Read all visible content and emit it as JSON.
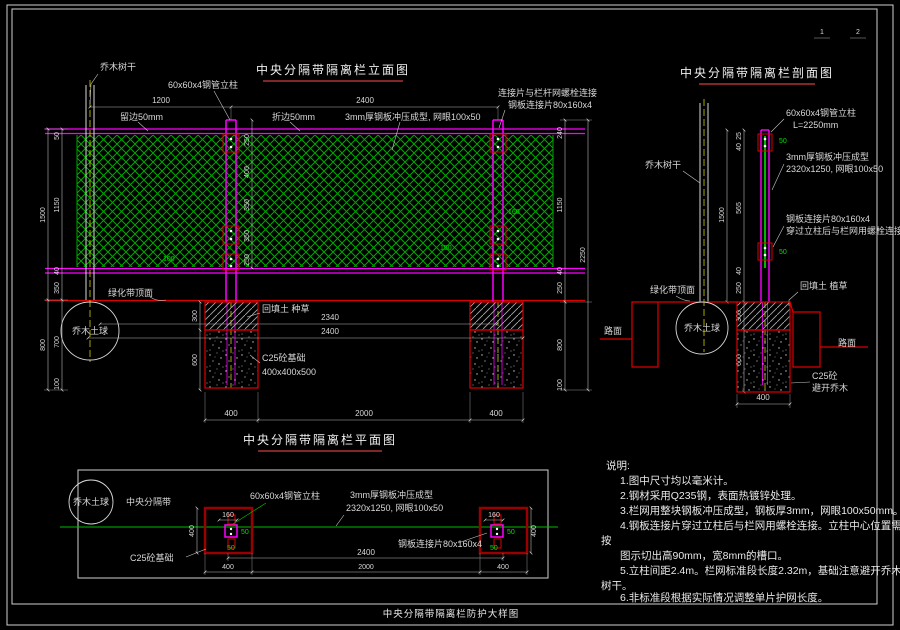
{
  "sheet": {
    "footer_title": "中央分隔带隔离栏防护大样图",
    "page_no_1": "1",
    "page_no_2": "2"
  },
  "elevation": {
    "title": "中央分隔带隔离栏立面图",
    "labels": {
      "tree_trunk": "乔木树干",
      "post": "60x60x4钢管立柱",
      "edge_left": "留边50mm",
      "edge_right": "折边50mm",
      "mesh": "3mm厚钢板冲压成型, 网眼100x50",
      "connect_line1": "连接片与栏杆网螺栓连接",
      "connect_line2": "钢板连接片80x160x4",
      "greenbelt_top": "绿化带顶面",
      "backfill": "回填土 种草",
      "foundation_line1": "C25砼基础",
      "foundation_line2": "400x400x500",
      "tree_ball": "乔木土球"
    },
    "dims": {
      "tree_to_post": "1200",
      "post_spacing": "2400",
      "left_total": "1500",
      "left_top": "50",
      "left_mesh": "1150",
      "left_rail": "40",
      "left_bottom": "350",
      "left_below_total": "800",
      "left_below_1": "700",
      "left_below_2": "100",
      "mid_1": "250",
      "mid_2": "400",
      "mid_3": "350",
      "mid_4": "350",
      "mid_5": "250",
      "right_top": "240",
      "right_mesh": "1150",
      "right_rail": "40",
      "right_bottom": "250",
      "right_total": "2250",
      "right_below_1": "800",
      "right_below_2": "100",
      "hatch_depth": "300",
      "found_depth": "600",
      "panel_len": "2340",
      "bay_len": "2400",
      "found_left": "400",
      "found_gap": "2000",
      "found_right": "400",
      "bolt_1": "100",
      "bolt_2": "150",
      "bolt_3": "160"
    }
  },
  "section": {
    "title": "中央分隔带隔离栏剖面图",
    "labels": {
      "tree_trunk": "乔木树干",
      "post_line1": "60x60x4钢管立柱",
      "post_line2": "L=2250mm",
      "mesh_line1": "3mm厚钢板冲压成型",
      "mesh_line2": "2320x1250, 网眼100x50",
      "plate_line1": "钢板连接片80x160x4",
      "plate_line2": "穿过立柱后与栏网用螺栓连接",
      "backfill": "回填土 植草",
      "greenbelt_top": "绿化带顶面",
      "tree_ball": "乔木土球",
      "road_left": "路面",
      "road_right": "路面",
      "c25_line1": "C25砼",
      "c25_line2": "避开乔木"
    },
    "dims": {
      "top_1": "25",
      "top_2": "40",
      "mesh_upper": "565",
      "rail": "40",
      "to_ground": "250",
      "above_total": "1500",
      "hatch_depth": "300",
      "found_depth": "600",
      "found_width": "400",
      "bolt_top": "50",
      "bolt_mid": "50"
    }
  },
  "plan": {
    "title": "中央分隔带隔离栏平面图",
    "labels": {
      "tree_ball": "乔木土球",
      "median": "中央分隔带",
      "post": "60x60x4钢管立柱",
      "mesh_line1": "3mm厚钢板冲压成型",
      "mesh_line2": "2320x1250, 网眼100x50",
      "plate": "钢板连接片80x160x4",
      "foundation": "C25砼基础"
    },
    "dims": {
      "post_left": "160",
      "post_right": "160",
      "found_left_side": "400",
      "found_right_side": "400",
      "post_spacing": "2400",
      "found_left": "400",
      "found_gap": "2000",
      "found_right": "400",
      "bolt_1": "50",
      "bolt_2": "50",
      "bolt_3": "50",
      "bolt_4": "50"
    }
  },
  "notes": {
    "heading": "说明:",
    "lines": [
      "1.图中尺寸均以毫米计。",
      "2.钢材采用Q235钢，表面热镀锌处理。",
      "3.栏网用整块钢板冲压成型，钢板厚3mm，网眼100x50mm。",
      "4.钢板连接片穿过立柱后与栏网用螺栓连接。立柱中心位置需",
      "按",
      "图示切出高90mm，宽8mm的槽口。",
      "5.立柱间距2.4m。栏网标准段长度2.32m，基础注意避开乔木",
      "树干。",
      "6.非标准段根据实际情况调整单片护网长度。"
    ]
  }
}
